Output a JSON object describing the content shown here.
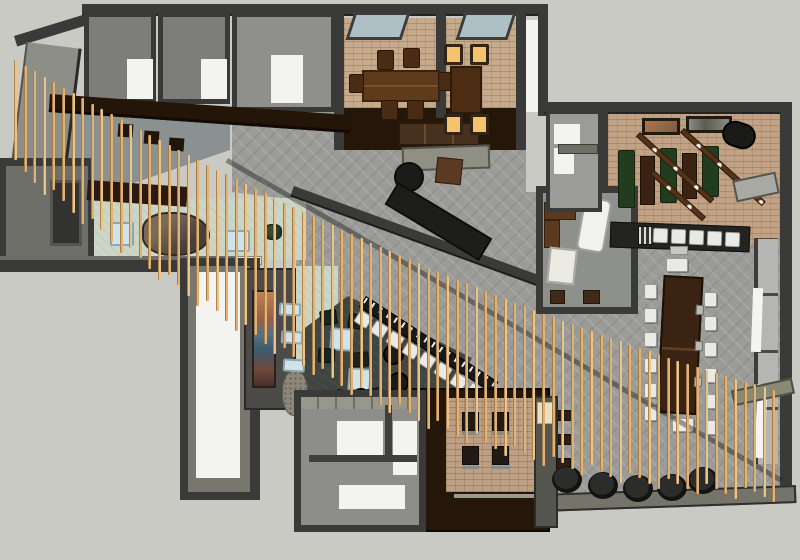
{
  "scene": {
    "title": "Overhead 3D floor-plan render of a restaurant interior",
    "style": "sketchup-axonometric-render",
    "visible_text": "none"
  },
  "palette": {
    "canvas": "#c9cac3",
    "wall_dark": "#3a3a38",
    "wall_edge": "#232321",
    "wall_face": "#8e8e89",
    "floor_gray": "#9b9c98",
    "floor_tan": "#c6aa8c",
    "floor_brick": "#bda084",
    "floor_sage": "#ccd6c6",
    "floor_lounge": "#40453f",
    "floor_white": "#f3f3f0",
    "wood_dark": "#5e3b1d",
    "wood_espresso": "#241609",
    "slat": "#dfb278",
    "slat_light": "#eac48d",
    "seat_white": "#e9e9e5",
    "bench_green": "#223d1e",
    "glow_amber": "#f3c46c",
    "table_blue": "#cfe3ea",
    "pouf_black": "#1a1a18",
    "window": "#aebfc6",
    "art_warm": "#c08055",
    "art_cool": "#3d5a6e"
  },
  "slat_screen": {
    "count": 80,
    "start_x": 14,
    "spacing": 9.6,
    "top_a": 60,
    "top_b": 5.6,
    "top_c": 0.018,
    "base_len": 100,
    "amp": 50
  },
  "inventory": {
    "private_dining_room_tables": 2,
    "private_dining_chairs_wood": 6,
    "private_dining_chairs_lit": 4,
    "skylights": 2,
    "communal_table_chairs": 14,
    "bar_stools": 8,
    "wing_counter_stools": 5,
    "green_booth_benches": 3,
    "lounge_chairs": 6,
    "lounge_side_tables": 2,
    "round_poufs_lounge": 3,
    "cylinder_poufs_bottom": 5,
    "booth_nook_chairs": 4,
    "framed_artworks_wing": 2,
    "large_mural": 1,
    "ceiling_slats": 80
  }
}
